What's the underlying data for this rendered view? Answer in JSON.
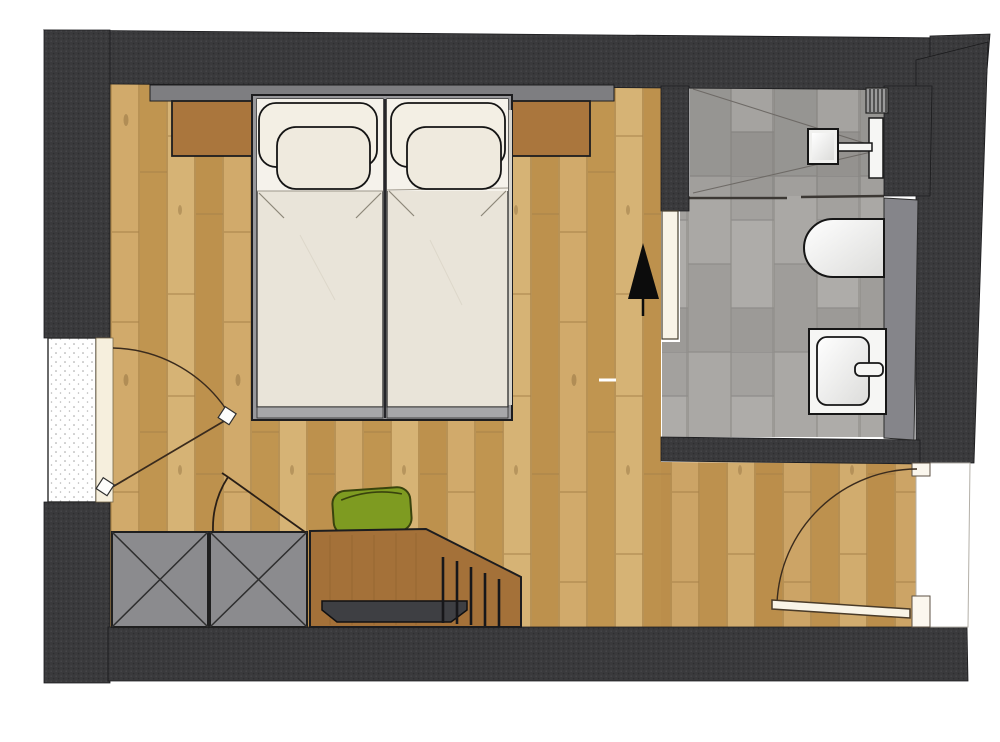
{
  "meta": {
    "title": "hotel-room-floor-plan",
    "view": "top-down-architectural-plan",
    "rooms": [
      {
        "name": "bedroom",
        "floor": "oak plank parquet"
      },
      {
        "name": "bathroom",
        "floor": "grey stone tile"
      },
      {
        "name": "entry-area",
        "floor": "oak plank parquet"
      }
    ],
    "furniture": [
      "double-bed-two-mattresses",
      "pillows",
      "nightstand-left",
      "nightstand-right",
      "headboard-panel",
      "minibar-cabinet-1",
      "minibar-cabinet-2",
      "desk",
      "desk-tray",
      "desk-chair",
      "radiator-slats"
    ],
    "fixtures": [
      "shower",
      "shower-head",
      "shower-rail",
      "shower-vent-grate",
      "toilet",
      "washbasin-vanity",
      "faucet",
      "bathroom-counter",
      "sliding-bathroom-door"
    ],
    "doors": [
      {
        "name": "balcony-door-left",
        "state": "open",
        "swing": "arc-shown"
      },
      {
        "name": "entry-door-bottom-right",
        "state": "open",
        "swing": "arc-shown"
      },
      {
        "name": "minibar-flap",
        "state": "open",
        "swing": "arc-shown"
      }
    ],
    "symbols": [
      "plant-north-marker",
      "floor-socket-mark"
    ]
  },
  "colors": {
    "wall": "#3a3a3c",
    "wall_dot": "#4a4a4c",
    "wood_base": "#c9a160",
    "wood_entry_tint": "#b07f3f",
    "tile_base": "#a6a4a1",
    "headboard": "#7e7e81",
    "nightstand": "#aa763d",
    "bed_frame": "#98989b",
    "bed_foot": "#a7a7a9",
    "mattress": "#e9e4d9",
    "sheet": "#f5f2eb",
    "pillow_big": "#f3efe4",
    "pillow_small": "#efeade",
    "cabinet": "#8b8b8e",
    "desk": "#a47139",
    "tray": "#3e3f43",
    "chair": "#7e9b21",
    "counter": "#85858a",
    "fixture_white": "#f6f6f4",
    "door_leaf": "#f9f4e7",
    "window_frame": "#f6efdd",
    "swing_line": "#3a2b1d",
    "plant_marker": "#0c0c0c",
    "corridor": "#ffffff"
  }
}
